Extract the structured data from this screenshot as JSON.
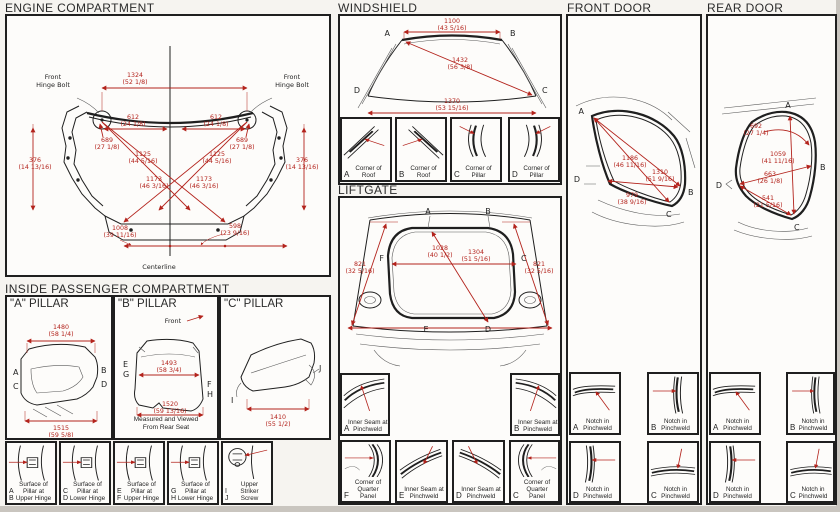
{
  "colors": {
    "red": "#b3231c",
    "ink": "#1f1f1f"
  },
  "engine": {
    "title": "ENGINE COMPARTMENT",
    "front_label": "Front",
    "hinge_bolt_label": "Hinge Bolt",
    "centerline_label": "Centerline",
    "dims": [
      {
        "mm": "1324",
        "in": "(52 1/8)"
      },
      {
        "mm": "612",
        "in": "(24 1/8)"
      },
      {
        "mm": "612",
        "in": "(24 1/8)"
      },
      {
        "mm": "689",
        "in": "(27 1/8)"
      },
      {
        "mm": "689",
        "in": "(27 1/8)"
      },
      {
        "mm": "376",
        "in": "(14 13/16)"
      },
      {
        "mm": "376",
        "in": "(14 13/16)"
      },
      {
        "mm": "1125",
        "in": "(44 5/16)"
      },
      {
        "mm": "1125",
        "in": "(44 5/16)"
      },
      {
        "mm": "1173",
        "in": "(46 3/16)"
      },
      {
        "mm": "1173",
        "in": "(46 3/16)"
      },
      {
        "mm": "1008",
        "in": "(39 11/16)"
      },
      {
        "mm": "598",
        "in": "(23 9/16)"
      }
    ]
  },
  "windshield": {
    "title": "WINDSHIELD",
    "points": [
      "A",
      "B",
      "C",
      "D"
    ],
    "dims": [
      {
        "mm": "1100",
        "in": "(43 5/16)"
      },
      {
        "mm": "1432",
        "in": "(56 3/8)"
      },
      {
        "mm": "1370",
        "in": "(53 15/16)"
      }
    ],
    "panels": [
      {
        "letter": "A",
        "line1": "Corner of",
        "line2": "Roof"
      },
      {
        "letter": "B",
        "line1": "Corner of",
        "line2": "Roof"
      },
      {
        "letter": "C",
        "line1": "Corner of",
        "line2": "Pillar"
      },
      {
        "letter": "D",
        "line1": "Corner of",
        "line2": "Pillar"
      }
    ]
  },
  "liftgate": {
    "title": "LIFTGATE",
    "points": [
      "A",
      "B",
      "C",
      "D",
      "E",
      "F"
    ],
    "dims": [
      {
        "mm": "821",
        "in": "(32 5/16)"
      },
      {
        "mm": "1028",
        "in": "(40 1/2)"
      },
      {
        "mm": "1304",
        "in": "(51 5/16)"
      },
      {
        "mm": "821",
        "in": "(32 5/16)"
      }
    ],
    "side_panels": [
      {
        "letter": "A",
        "line1": "Inner Seam at",
        "line2": "Pinchweld"
      },
      {
        "letter": "B",
        "line1": "Inner Seam at",
        "line2": "Pinchweld"
      }
    ],
    "bottom_panels": [
      {
        "letter": "F",
        "line1": "Corner of",
        "line2": "Quarter",
        "line3": "Panel"
      },
      {
        "letter": "E",
        "line1": "Inner Seam at",
        "line2": "Pinchweld",
        "line3": ""
      },
      {
        "letter": "D",
        "line1": "Inner Seam at",
        "line2": "Pinchweld",
        "line3": ""
      },
      {
        "letter": "C",
        "line1": "Corner of",
        "line2": "Quarter",
        "line3": "Panel"
      }
    ]
  },
  "front_door": {
    "title": "FRONT DOOR",
    "points": [
      "A",
      "B",
      "C",
      "D"
    ],
    "dims": [
      {
        "mm": "1186",
        "in": "(46 11/16)"
      },
      {
        "mm": "1310",
        "in": "(51 9/16)"
      },
      {
        "mm": "979",
        "in": "(38 9/16)"
      }
    ],
    "panels": [
      {
        "letter": "A",
        "line1": "Notch in",
        "line2": "Pinchweld"
      },
      {
        "letter": "B",
        "line1": "Notch in",
        "line2": "Pinchweld"
      },
      {
        "letter": "D",
        "line1": "Notch in",
        "line2": "Pinchweld"
      },
      {
        "letter": "C",
        "line1": "Notch in",
        "line2": "Pinchweld"
      }
    ]
  },
  "rear_door": {
    "title": "REAR DOOR",
    "points": [
      "A",
      "B",
      "C",
      "D"
    ],
    "dims": [
      {
        "mm": "692",
        "in": "(27 1/4)"
      },
      {
        "mm": "1059",
        "in": "(41 11/16)"
      },
      {
        "mm": "663",
        "in": "(26 1/8)"
      },
      {
        "mm": "541",
        "in": "(21 5/16)"
      }
    ],
    "panels": [
      {
        "letter": "A",
        "line1": "Notch in",
        "line2": "Pinchweld"
      },
      {
        "letter": "B",
        "line1": "Notch in",
        "line2": "Pinchweld"
      },
      {
        "letter": "D",
        "line1": "Notch in",
        "line2": "Pinchweld"
      },
      {
        "letter": "C",
        "line1": "Notch in",
        "line2": "Pinchweld"
      }
    ]
  },
  "interior": {
    "title": "INSIDE PASSENGER COMPARTMENT",
    "a_pillar": {
      "title": "\"A\" PILLAR",
      "points": [
        "A",
        "B",
        "C",
        "D"
      ],
      "dims": [
        {
          "mm": "1480",
          "in": "(58 1/4)"
        },
        {
          "mm": "1515",
          "in": "(59 5/8)"
        }
      ]
    },
    "b_pillar": {
      "title": "\"B\" PILLAR",
      "front_label": "Front",
      "points": [
        "E",
        "F",
        "G",
        "H"
      ],
      "dims": [
        {
          "mm": "1493",
          "in": "(58 3/4)"
        },
        {
          "mm": "1520",
          "in": "(59 13/16)"
        }
      ],
      "note1": "Measured and Viewed",
      "note2": "From Rear Seat"
    },
    "c_pillar": {
      "title": "\"C\" PILLAR",
      "points": [
        "I",
        "J"
      ],
      "dims": [
        {
          "mm": "1410",
          "in": "(55 1/2)"
        }
      ]
    },
    "panels": [
      {
        "letter1": "A",
        "letter2": "B",
        "line1": "Surface of",
        "line2": "Pillar at",
        "line3": "Upper Hinge"
      },
      {
        "letter1": "C",
        "letter2": "D",
        "line1": "Surface of",
        "line2": "Pillar at",
        "line3": "Lower Hinge"
      },
      {
        "letter1": "E",
        "letter2": "F",
        "line1": "Surface of",
        "line2": "Pillar at",
        "line3": "Upper Hinge"
      },
      {
        "letter1": "G",
        "letter2": "H",
        "line1": "Surface of",
        "line2": "Pillar at",
        "line3": "Lower Hinge"
      },
      {
        "letter1": "I",
        "letter2": "J",
        "line1": "Upper",
        "line2": "Striker",
        "line3": "Screw"
      }
    ]
  }
}
